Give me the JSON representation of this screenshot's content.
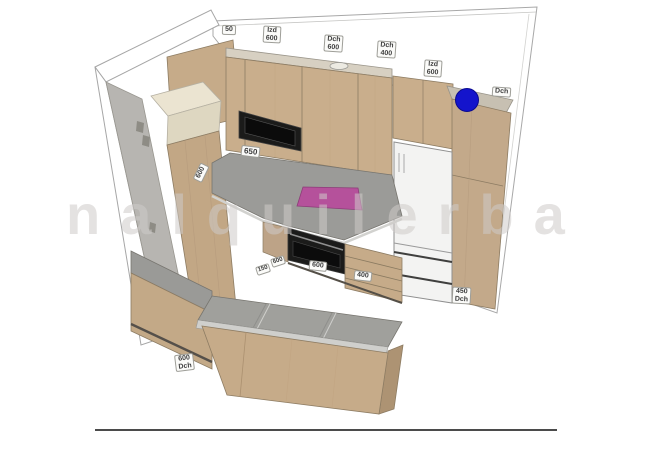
{
  "watermark_text": "nalquilerba",
  "labels": {
    "wall_cab_0": "50",
    "wall_cab_1": "Izd\n600",
    "wall_cab_2": "Dch\n600",
    "wall_cab_3": "Dch\n400",
    "wall_cab_4": "Izd\n600",
    "tall_right": "Dch",
    "counter": "650",
    "tall_left": "600",
    "base_filler": "150",
    "base_0": "600",
    "base_1": "600",
    "base_2": "400",
    "base_right": "450\nDch",
    "base_left": "600\nDch"
  },
  "marker": {
    "name": "blue-pin",
    "color": "#1414cc"
  },
  "palette": {
    "cabinet_wood": "#c9ae8c",
    "countertop": "#9b9b98",
    "hob": "#b5519b",
    "wall_gray": "#b7b5b1",
    "appliance_black": "#1b1b1a",
    "fridge_white": "#f3f3f2"
  }
}
